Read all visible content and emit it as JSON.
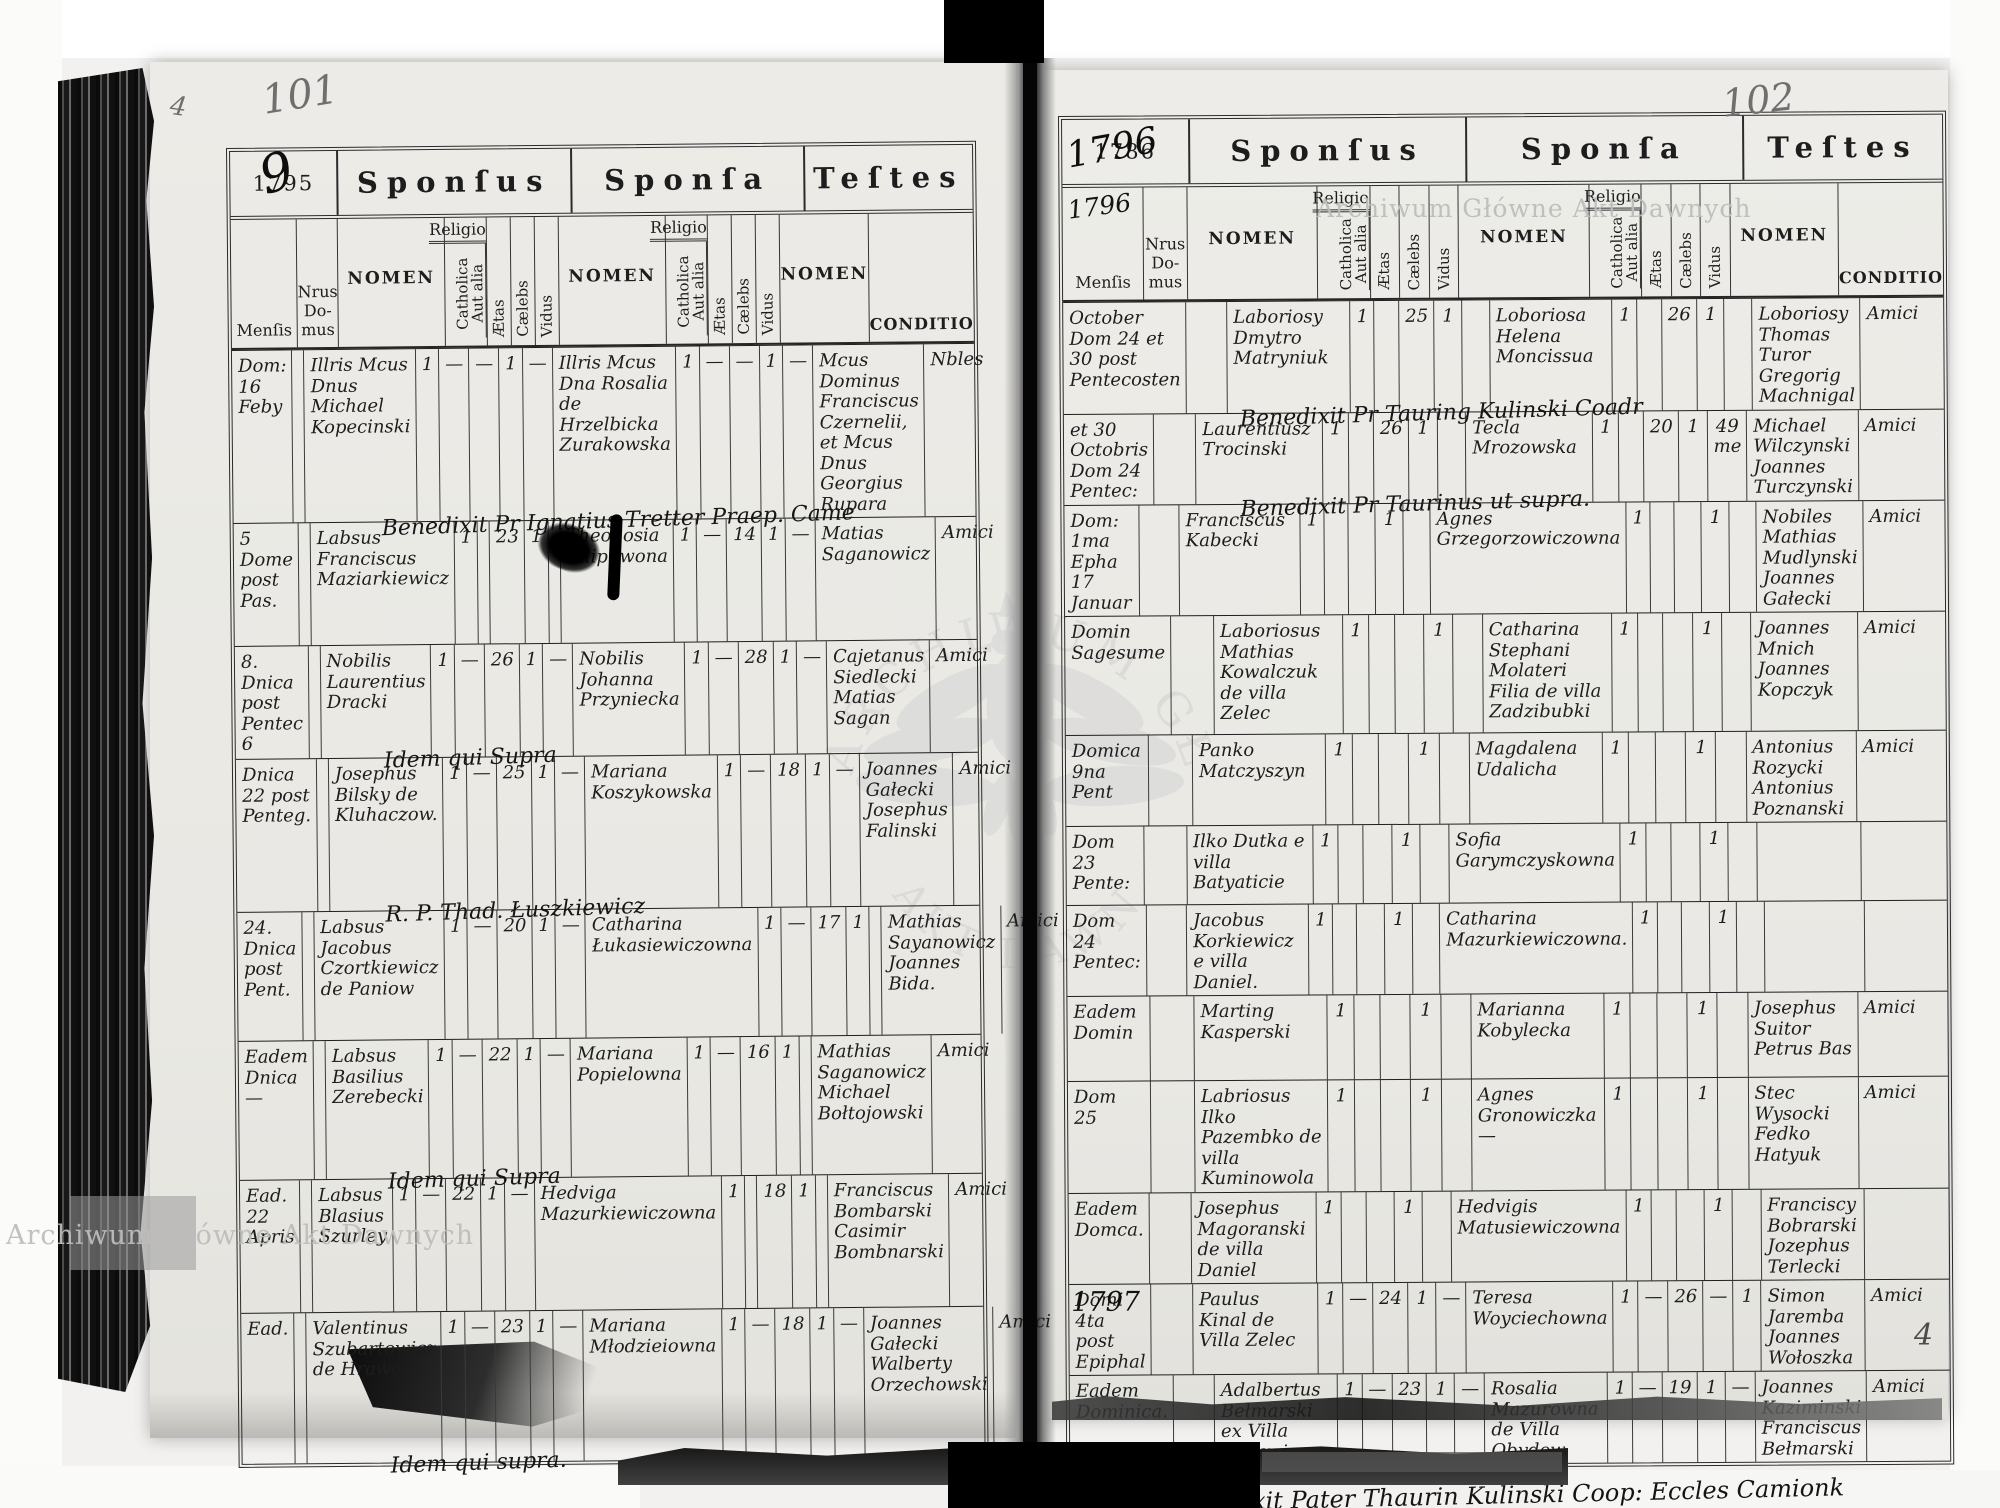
{
  "document": {
    "archive_watermark": "Archiwum Główne Akt Dawnych",
    "watermark_arc_top": "ARCHIWUM GŁÓWNE",
    "watermark_arc_bottom": "AKT DAWNYCH",
    "page_number_left": "101",
    "page_number_right": "102",
    "corner_mark_left": "4",
    "corner_mark_right": "4",
    "ink_color": "#1d1d1d",
    "pencil_color": "#6f6f6f",
    "watermark_color": "#bdbdbd"
  },
  "sections": {
    "sponsus": "Sponſus",
    "sponsa": "Sponſa",
    "testes": "Teſtes"
  },
  "columns": {
    "mensis": "Menſis",
    "nrus_domus": "Nrus Do-mus",
    "nomen": "NOMEN",
    "religio": "Religio",
    "catholica": "Catholica",
    "aut_alia": "Aut alia",
    "aetas": "Ætas",
    "caelebs": "Cælebs",
    "vidus": "Vidus",
    "conditio": "CONDITIO"
  },
  "pages": [
    {
      "year_printed": "1795",
      "year_overlay": "9",
      "year_script_below": "",
      "footer_note": "",
      "rows": [
        {
          "mensis": "Dom: 16 Feby",
          "nrus": "",
          "sponsus": "Illris Mcus Dnus Michael Kopecinski",
          "sponsus_marks": [
            "1",
            "—",
            "—",
            "1",
            "—"
          ],
          "sponsa": "Illris Mcus Dna Rosalia de Hrzelbicka Zurakowska",
          "sponsa_marks": [
            "1",
            "—",
            "—",
            "1",
            "—"
          ],
          "testes": "Mcus Dominus Franciscus Czernelii, et Mcus Dnus Georgius Rupara",
          "conditio": "Nbles",
          "note": "Benedixit Pr Ignatius Tretter Praep. Came",
          "margin_year": ""
        },
        {
          "mensis": "5 Dome post Pas.",
          "nrus": "",
          "sponsus": "Labsus Franciscus Maziarkiewicz",
          "sponsus_marks": [
            "1",
            "",
            "23",
            "1",
            ""
          ],
          "sponsa": "Theodosia Filipuwona",
          "sponsa_marks": [
            "1",
            "—",
            "14",
            "1",
            "—"
          ],
          "testes": "Matias Saganowicz",
          "conditio": "Amici",
          "note": "",
          "margin_year": ""
        },
        {
          "mensis": "8. Dnica post Pentec 6",
          "nrus": "",
          "sponsus": "Nobilis Laurentius Dracki",
          "sponsus_marks": [
            "1",
            "—",
            "26",
            "1",
            "—"
          ],
          "sponsa": "Nobilis Johanna Przyniecka",
          "sponsa_marks": [
            "1",
            "—",
            "28",
            "1",
            "—"
          ],
          "testes": "Cajetanus Siedlecki Matias Sagan",
          "conditio": "Amici",
          "note": "Idem qui Supra",
          "margin_year": ""
        },
        {
          "mensis": "Dnica 22 post Penteg.",
          "nrus": "",
          "sponsus": "Josephus Bilsky de Kluhaczow.",
          "sponsus_marks": [
            "1",
            "—",
            "25",
            "1",
            "—"
          ],
          "sponsa": "Mariana Koszykowska",
          "sponsa_marks": [
            "1",
            "—",
            "18",
            "1",
            "—"
          ],
          "testes": "Joannes Gałecki Josephus Falinski",
          "conditio": "Amici",
          "note": "R. P. Thad. Łuszkiewicz",
          "margin_year": ""
        },
        {
          "mensis": "24. Dnica post Pent.",
          "nrus": "",
          "sponsus": "Labsus Jacobus Czortkiewicz de Paniow",
          "sponsus_marks": [
            "1",
            "—",
            "20",
            "1",
            "—"
          ],
          "sponsa": "Catharina Łukasiewiczowna",
          "sponsa_marks": [
            "1",
            "—",
            "17",
            "1",
            ""
          ],
          "testes": "Mathias Sayanowicz Joannes Bida.",
          "conditio": "Amici",
          "note": "",
          "margin_year": ""
        },
        {
          "mensis": "Eadem Dnica —",
          "nrus": "",
          "sponsus": "Labsus Basilius Zerebecki",
          "sponsus_marks": [
            "1",
            "—",
            "22",
            "1",
            "—"
          ],
          "sponsa": "Mariana Popielowna",
          "sponsa_marks": [
            "1",
            "—",
            "16",
            "1",
            ""
          ],
          "testes": "Mathias Saganowicz Michael Bołtojowski",
          "conditio": "Amici",
          "note": "Idem qui Supra",
          "margin_year": ""
        },
        {
          "mensis": "Ead. 22 Apris",
          "nrus": "",
          "sponsus": "Labsus Blasius Szurley",
          "sponsus_marks": [
            "1",
            "—",
            "22",
            "1",
            "—"
          ],
          "sponsa": "Hedviga Mazurkiewiczowna",
          "sponsa_marks": [
            "1",
            "",
            "18",
            "1",
            ""
          ],
          "testes": "Franciscus Bombarski Casimir Bombnarski",
          "conditio": "Amici",
          "note": "",
          "margin_year": ""
        },
        {
          "mensis": "Ead.",
          "nrus": "",
          "sponsus": "Valentinus Szubartowicz de Hrawa",
          "sponsus_marks": [
            "1",
            "—",
            "23",
            "1",
            "—"
          ],
          "sponsa": "Mariana Młodzieiowna",
          "sponsa_marks": [
            "1",
            "—",
            "18",
            "1",
            "—"
          ],
          "testes": "Joannes Gałecki Walberty Orzechowski",
          "conditio": "Amici",
          "note": "Idem qui supra.",
          "margin_year": ""
        }
      ]
    },
    {
      "year_printed": "1786",
      "year_overlay": "1796",
      "year_script_below": "1796",
      "footer_note": "Benedixit Pater Thaurin Kulinski Coop: Eccles Camionk",
      "rows": [
        {
          "mensis": "October Dom 24 et 30 post Pentecosten",
          "nrus": "",
          "sponsus": "Laboriosy Dmytro Matryniuk",
          "sponsus_marks": [
            "1",
            "",
            "25",
            "1",
            ""
          ],
          "sponsa": "Loboriosa Helena Moncissua",
          "sponsa_marks": [
            "1",
            "",
            "26",
            "1",
            ""
          ],
          "testes": "Loboriosy Thomas Turor Gregorig Machnigal",
          "conditio": "Amici",
          "note": "Benedixit Pr Tauring Kulinski Coadr",
          "margin_year": ""
        },
        {
          "mensis": "et 30 Octobris Dom 24 Pentec:",
          "nrus": "",
          "sponsus": "Laurentiusz Trocinski",
          "sponsus_marks": [
            "1",
            "",
            "26",
            "1",
            ""
          ],
          "sponsa": "Tecla Mrozowska",
          "sponsa_marks": [
            "1",
            "",
            "20",
            "1",
            "49 me"
          ],
          "testes": "Michael Wilczynski Joannes Turczynski",
          "conditio": "Amici",
          "note": "Benedixit Pr Taurinus ut supra.",
          "margin_year": ""
        },
        {
          "mensis": "Dom: 1ma Epha 17 Januar",
          "nrus": "",
          "sponsus": "Franciscus Kabecki",
          "sponsus_marks": [
            "1",
            "",
            "",
            "1",
            ""
          ],
          "sponsa": "Agnes Grzegorzowiczowna",
          "sponsa_marks": [
            "1",
            "",
            "",
            "1",
            ""
          ],
          "testes": "Nobiles Mathias Mudlynski Joannes Gałecki",
          "conditio": "Amici",
          "note": "",
          "margin_year": ""
        },
        {
          "mensis": "Domin Sagesume",
          "nrus": "",
          "sponsus": "Laboriosus Mathias Kowalczuk de villa Zelec",
          "sponsus_marks": [
            "1",
            "",
            "",
            "1",
            ""
          ],
          "sponsa": "Catharina Stephani Molateri Filia de villa Zadzibubki",
          "sponsa_marks": [
            "1",
            "",
            "",
            "1",
            ""
          ],
          "testes": "Joannes Mnich Joannes Kopczyk",
          "conditio": "Amici",
          "note": "",
          "margin_year": ""
        },
        {
          "mensis": "Domica 9na Pent",
          "nrus": "",
          "sponsus": "Panko Matczyszyn",
          "sponsus_marks": [
            "1",
            "",
            "",
            "1",
            ""
          ],
          "sponsa": "Magdalena Udalicha",
          "sponsa_marks": [
            "1",
            "",
            "",
            "1",
            ""
          ],
          "testes": "Antonius Rozycki Antonius Poznanski",
          "conditio": "Amici",
          "note": "",
          "margin_year": ""
        },
        {
          "mensis": "Dom 23 Pente:",
          "nrus": "",
          "sponsus": "Ilko Dutka e villa Batyaticie",
          "sponsus_marks": [
            "1",
            "",
            "",
            "1",
            ""
          ],
          "sponsa": "Sofia Garymczyskowna",
          "sponsa_marks": [
            "1",
            "",
            "",
            "1",
            ""
          ],
          "testes": "",
          "conditio": "",
          "note": "",
          "margin_year": ""
        },
        {
          "mensis": "Dom 24 Pentec:",
          "nrus": "",
          "sponsus": "Jacobus Korkiewicz e villa Daniel.",
          "sponsus_marks": [
            "1",
            "",
            "",
            "1",
            ""
          ],
          "sponsa": "Catharina Mazurkiewiczowna.",
          "sponsa_marks": [
            "1",
            "",
            "",
            "1",
            ""
          ],
          "testes": "",
          "conditio": "",
          "note": "",
          "margin_year": ""
        },
        {
          "mensis": "Eadem Domin",
          "nrus": "",
          "sponsus": "Marting Kasperski",
          "sponsus_marks": [
            "1",
            "",
            "",
            "1",
            ""
          ],
          "sponsa": "Marianna Kobylecka",
          "sponsa_marks": [
            "1",
            "",
            "",
            "1",
            ""
          ],
          "testes": "Josephus Suitor Petrus Bas",
          "conditio": "Amici",
          "note": "",
          "margin_year": ""
        },
        {
          "mensis": "Dom 25",
          "nrus": "",
          "sponsus": "Labriosus Ilko Pazembko de villa Kuminowola",
          "sponsus_marks": [
            "1",
            "",
            "",
            "1",
            ""
          ],
          "sponsa": "Agnes Gronowiczka —",
          "sponsa_marks": [
            "1",
            "",
            "",
            "1",
            ""
          ],
          "testes": "Stec Wysocki Fedko Hatyuk",
          "conditio": "Amici",
          "note": "",
          "margin_year": ""
        },
        {
          "mensis": "Eadem Domca.",
          "nrus": "",
          "sponsus": "Josephus Magoranski de villa Daniel",
          "sponsus_marks": [
            "1",
            "",
            "",
            "1",
            ""
          ],
          "sponsa": "Hedvigis Matusiewiczowna",
          "sponsa_marks": [
            "1",
            "",
            "",
            "1",
            ""
          ],
          "testes": "Franciscy Bobrarski Jozephus Terlecki",
          "conditio": "",
          "note": "",
          "margin_year": "1797"
        },
        {
          "mensis": "Domi 4ta post Epiphal",
          "nrus": "",
          "sponsus": "Paulus Kinal de Villa Zelec",
          "sponsus_marks": [
            "1",
            "—",
            "24",
            "1",
            "—"
          ],
          "sponsa": "Teresa Woyciechowna",
          "sponsa_marks": [
            "1",
            "—",
            "26",
            "—",
            "1"
          ],
          "testes": "Simon Jaremba Joannes Wołoszka",
          "conditio": "Amici",
          "note": "",
          "margin_year": ""
        },
        {
          "mensis": "Eadem Dominica.",
          "nrus": "",
          "sponsus": "Adalbertus Bełmarski ex Villa Herawica",
          "sponsus_marks": [
            "1",
            "—",
            "23",
            "1",
            "—"
          ],
          "sponsa": "Rosalia Mazurowna de Villa Obydow",
          "sponsa_marks": [
            "1",
            "—",
            "19",
            "1",
            "—"
          ],
          "testes": "Joannes Kaziminski Franciscus Bełmarski",
          "conditio": "Amici",
          "note": "",
          "margin_year": ""
        }
      ]
    }
  ]
}
